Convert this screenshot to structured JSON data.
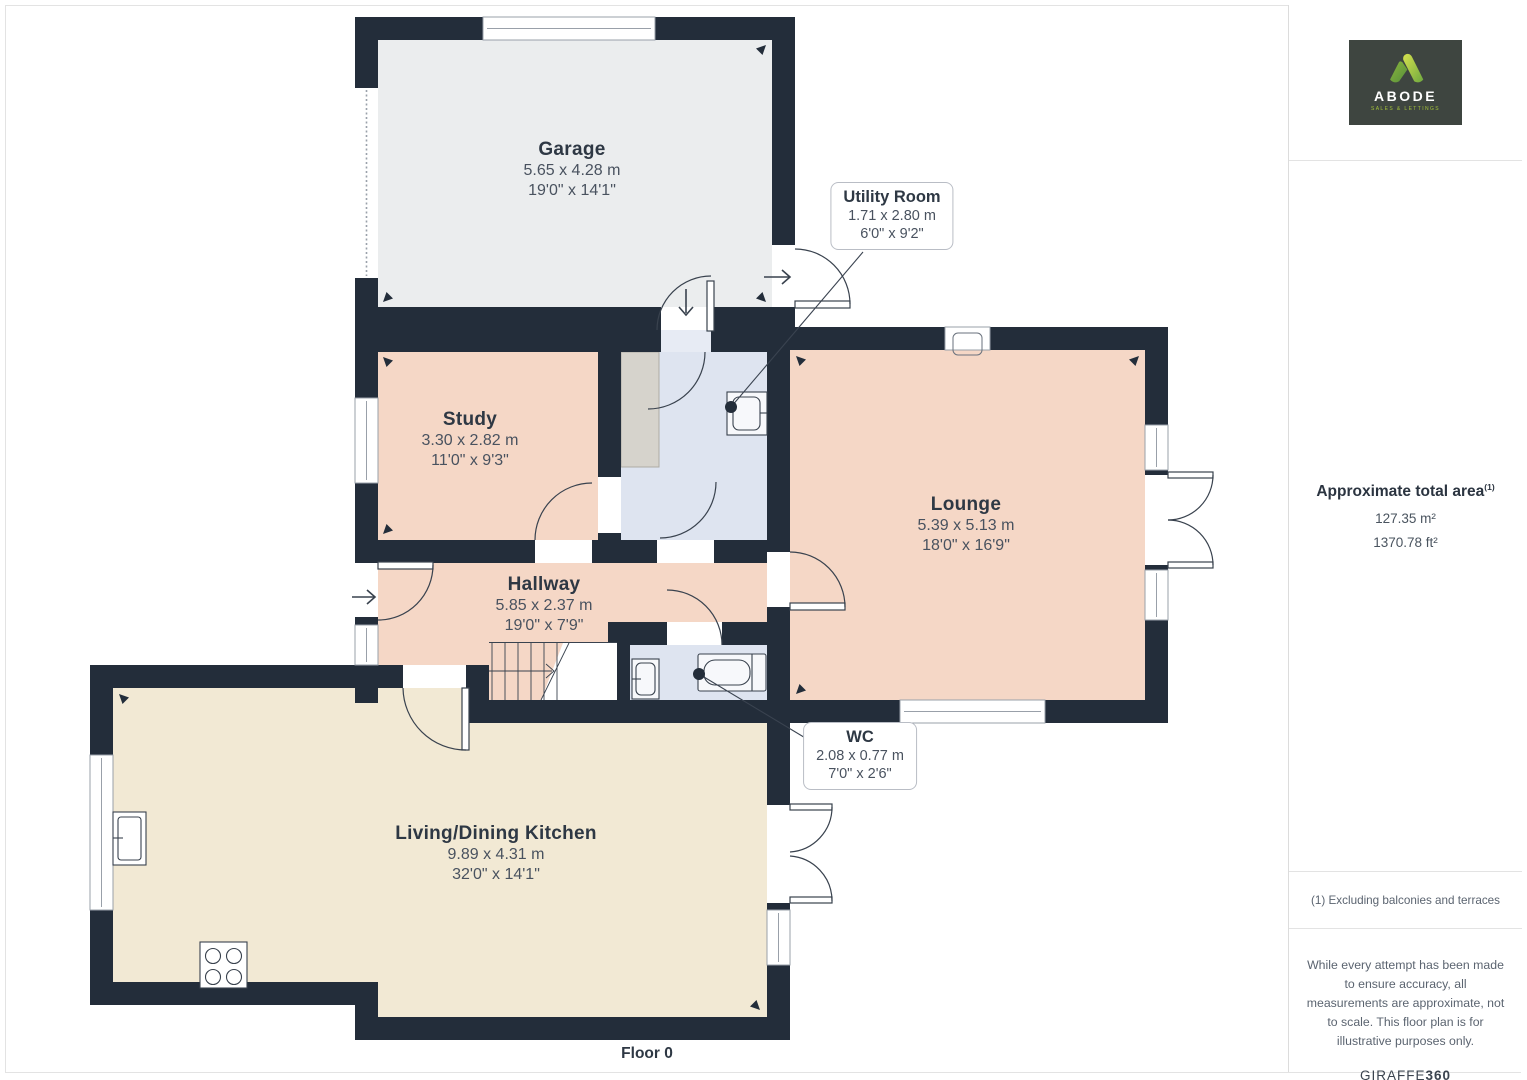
{
  "plan": {
    "floor_label": "Floor 0",
    "rooms": {
      "garage": {
        "name": "Garage",
        "dim_m": "5.65 x 4.28 m",
        "dim_ft": "19'0\" x 14'1\""
      },
      "study": {
        "name": "Study",
        "dim_m": "3.30 x 2.82 m",
        "dim_ft": "11'0\" x 9'3\""
      },
      "lounge": {
        "name": "Lounge",
        "dim_m": "5.39 x 5.13 m",
        "dim_ft": "18'0\" x 16'9\""
      },
      "hallway": {
        "name": "Hallway",
        "dim_m": "5.85 x 2.37 m",
        "dim_ft": "19'0\" x 7'9\""
      },
      "kitchen": {
        "name": "Living/Dining Kitchen",
        "dim_m": "9.89 x 4.31 m",
        "dim_ft": "32'0\" x 14'1\""
      },
      "utility": {
        "name": "Utility Room",
        "dim_m": "1.71 x 2.80 m",
        "dim_ft": "6'0\" x 9'2\""
      },
      "wc": {
        "name": "WC",
        "dim_m": "2.08 x 0.77 m",
        "dim_ft": "7'0\" x 2'6\""
      }
    }
  },
  "sidebar": {
    "logo": {
      "brand": "ABODE",
      "tagline": "SALES & LETTINGS"
    },
    "area_title": "Approximate total area",
    "area_superscript": "(1)",
    "area_m2": "127.35 m²",
    "area_ft2": "1370.78 ft²",
    "note": "(1) Excluding balconies and terraces",
    "disclaimer": "While every attempt has been made to ensure accuracy, all measurements are approximate, not to scale. This floor plan is for illustrative purposes only.",
    "credit_prefix": "GIRAFFE",
    "credit_suffix": "360"
  },
  "colors": {
    "wall": "#232d3a",
    "room_peach": "#f5d7c6",
    "room_blue": "#dee4f0",
    "room_cream": "#f2e9d4",
    "room_garage_gray": "#ebedee",
    "counter_gray": "#d6d3cc",
    "logo_bg": "#3e4540",
    "logo_green": "#a3c13a"
  }
}
